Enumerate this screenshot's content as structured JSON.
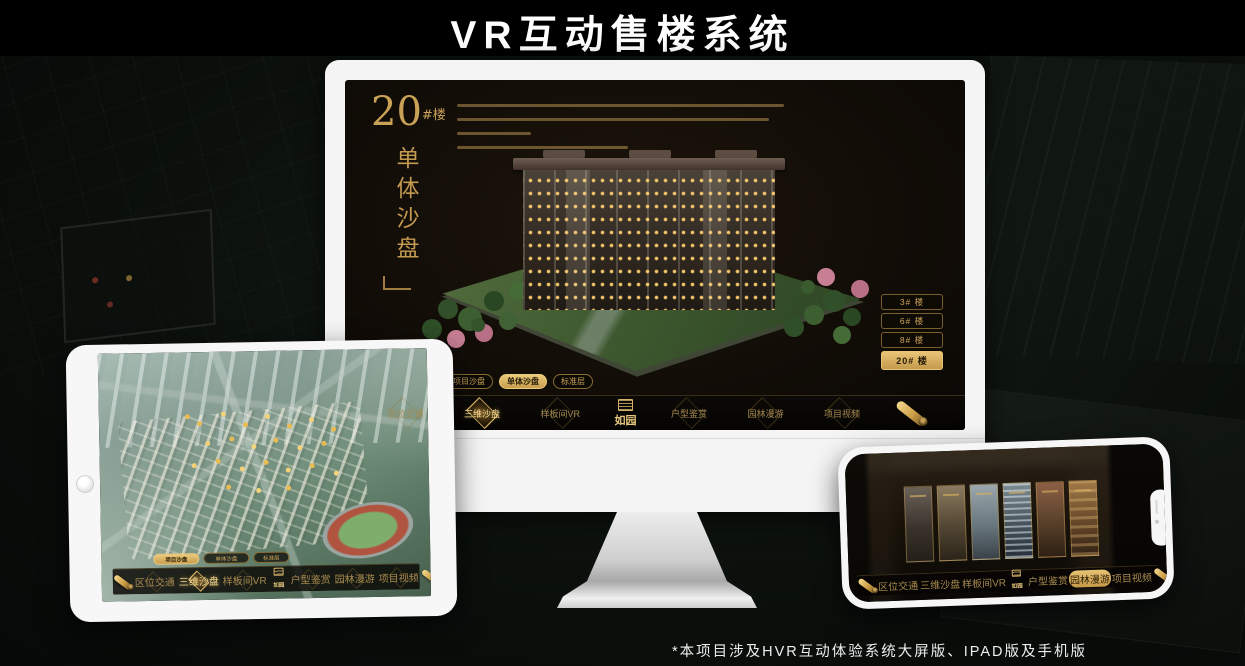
{
  "page": {
    "title": "VR互动售楼系统",
    "footnote": "*本项目涉及HVR互动体验系统大屏版、IPAD版及手机版"
  },
  "colors": {
    "gold": "#d2a855",
    "gold_bright": "#eec874",
    "screen_bg": "#14100a"
  },
  "monitor": {
    "hero": {
      "number": "20",
      "unit": "#楼",
      "subtitle": "单体沙盘"
    },
    "floor_buttons": [
      {
        "label": "3# 楼",
        "active": false
      },
      {
        "label": "6# 楼",
        "active": false
      },
      {
        "label": "8# 楼",
        "active": false
      },
      {
        "label": "20# 楼",
        "active": true
      }
    ],
    "sub_tabs": [
      {
        "label": "项目沙盘",
        "active": false
      },
      {
        "label": "单体沙盘",
        "active": true
      },
      {
        "label": "标准层",
        "active": false
      }
    ],
    "nav": {
      "items": [
        {
          "label": "区位交通",
          "active": false
        },
        {
          "label": "三维沙盘",
          "active": true
        },
        {
          "label": "样板间VR",
          "active": false
        },
        {
          "label": "户型鉴赏",
          "active": false
        },
        {
          "label": "园林漫游",
          "active": false
        },
        {
          "label": "项目视频",
          "active": false
        }
      ],
      "logo": "如园"
    }
  },
  "tablet": {
    "sub_tabs": [
      {
        "label": "项目沙盘",
        "active": true
      },
      {
        "label": "单体沙盘",
        "active": false
      },
      {
        "label": "标准层",
        "active": false
      }
    ],
    "nav": {
      "items": [
        {
          "label": "区位交通",
          "active": false
        },
        {
          "label": "三维沙盘",
          "active": true
        },
        {
          "label": "样板间VR",
          "active": false
        },
        {
          "label": "户型鉴赏",
          "active": false
        },
        {
          "label": "园林漫游",
          "active": false
        },
        {
          "label": "项目视频",
          "active": false
        }
      ],
      "logo": "如园"
    }
  },
  "phone": {
    "nav": {
      "items": [
        {
          "label": "区位交通",
          "active": false
        },
        {
          "label": "三维沙盘",
          "active": false
        },
        {
          "label": "样板间VR",
          "active": false
        },
        {
          "label": "户型鉴赏",
          "active": false
        },
        {
          "label": "园林漫游",
          "active": true
        },
        {
          "label": "项目视频",
          "active": false
        }
      ],
      "logo": "如园"
    }
  }
}
